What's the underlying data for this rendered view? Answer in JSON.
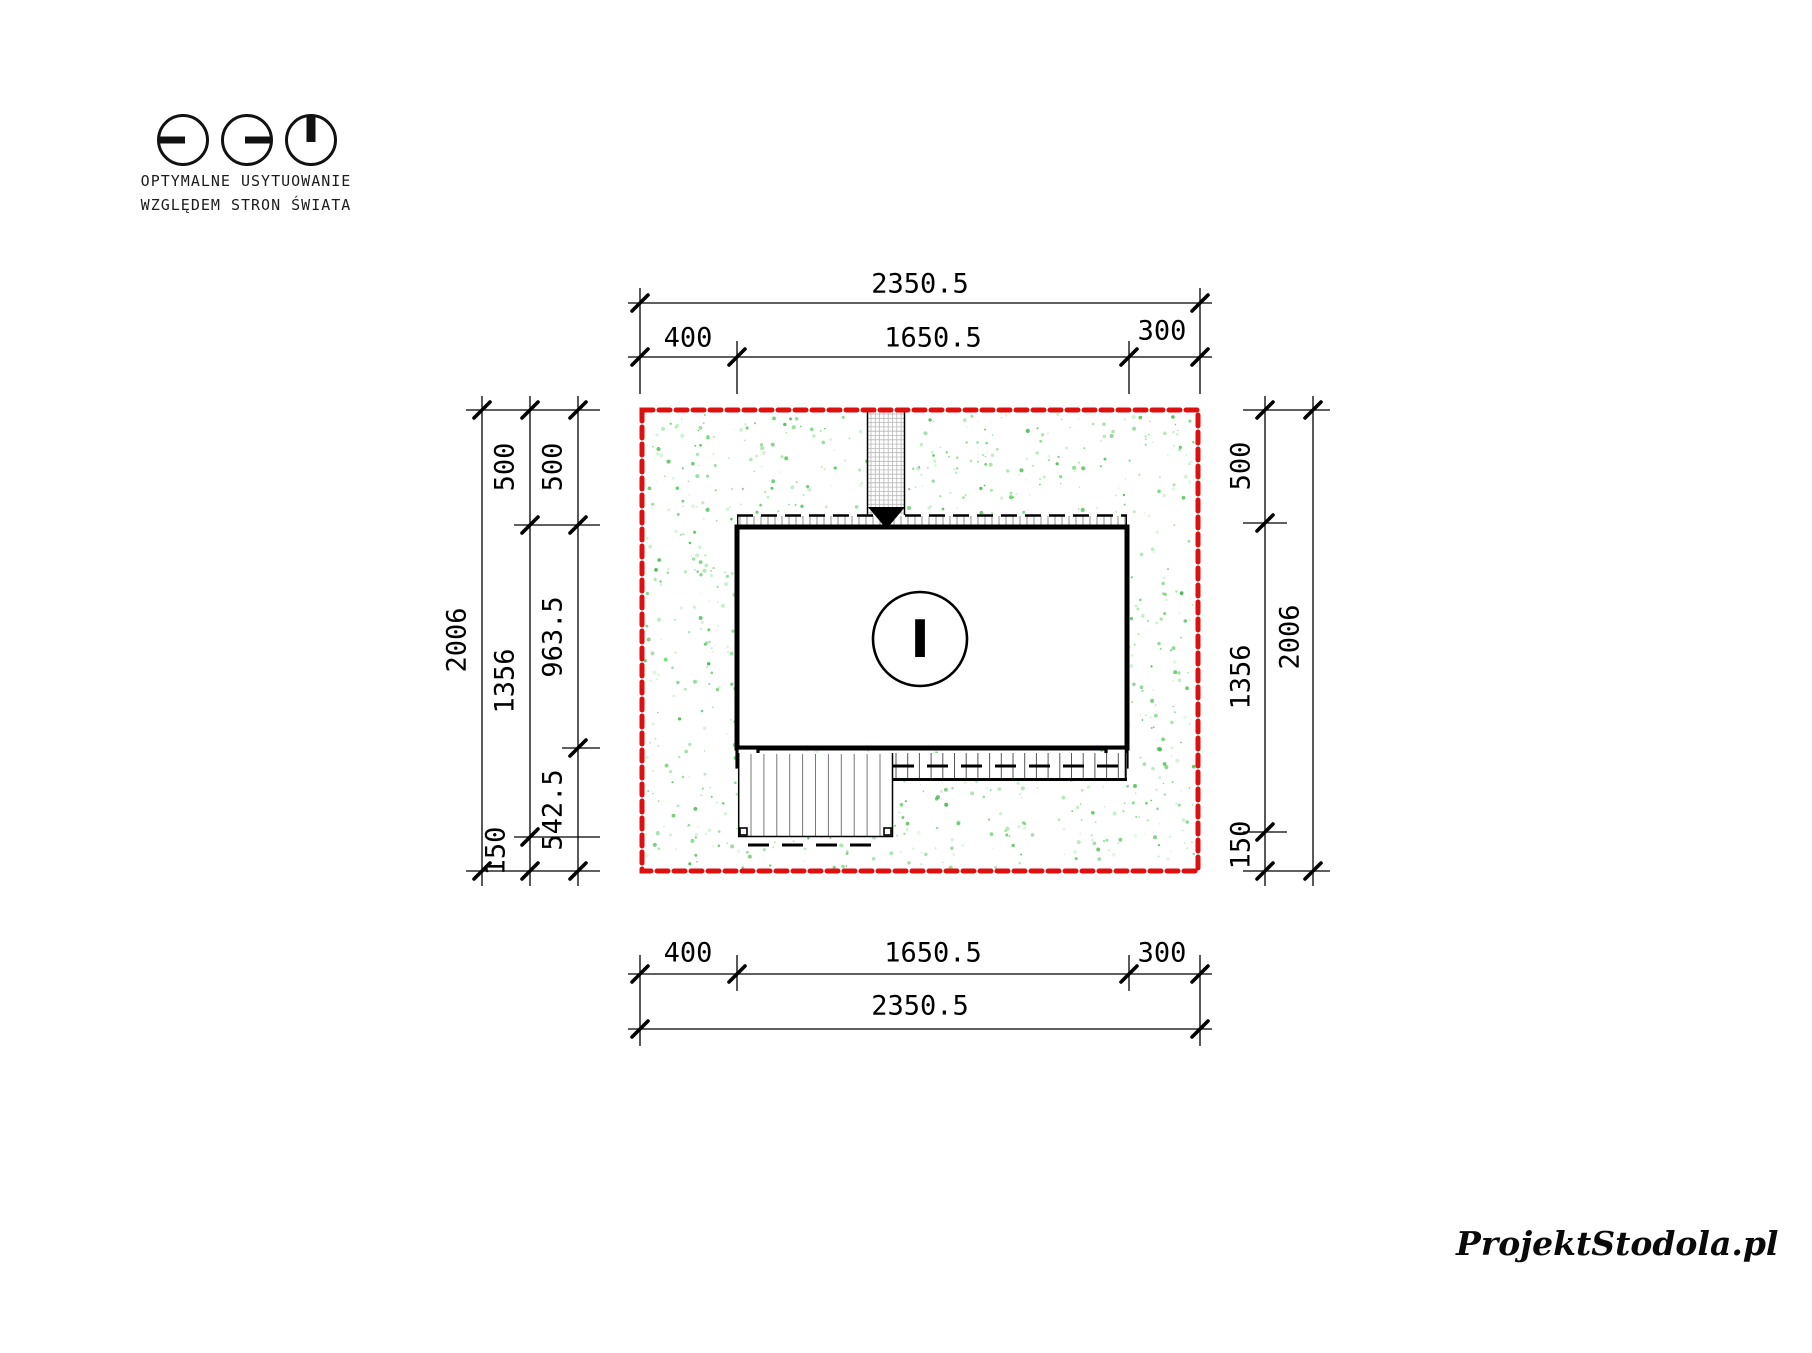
{
  "legend": {
    "title_line1": "OPTYMALNE USYTUOWANIE",
    "title_line2": "WZGLĘDEM STRON ŚWIATA",
    "icons": [
      "clock-9am-icon",
      "clock-3pm-icon",
      "clock-noon-icon"
    ]
  },
  "dimensions": {
    "top": {
      "total": "2350.5",
      "segments": [
        "400",
        "1650.5",
        "300"
      ]
    },
    "bottom": {
      "total": "2350.5",
      "segments": [
        "400",
        "1650.5",
        "300"
      ]
    },
    "left": {
      "total": "2006",
      "mid_segments": [
        "500",
        "1356",
        "150"
      ],
      "inner_segments": [
        "500",
        "963.5",
        "542.5"
      ]
    },
    "right": {
      "total": "2006",
      "inner_segments": [
        "500",
        "1356",
        "150"
      ]
    }
  },
  "plan": {
    "story_label": "I",
    "entrance_icon": "entrance-arrow-icon"
  },
  "colors": {
    "plot_boundary": "#dd1010",
    "lawn_speckle": "#58c85c",
    "drawing_line": "#000000"
  },
  "watermark": {
    "text": "ProjektStodola.pl"
  }
}
